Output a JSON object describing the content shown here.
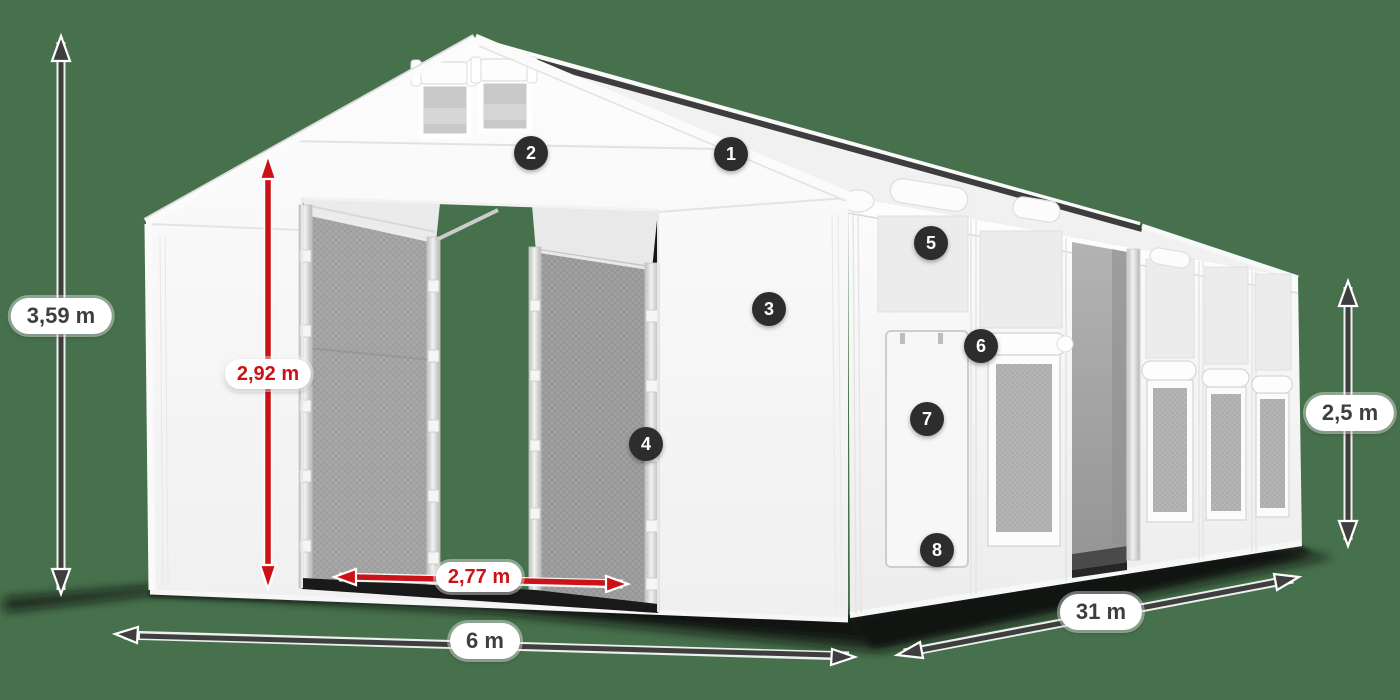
{
  "product_scene": {
    "description": "White PVC storage tent 6 m x 31 m, 3D product render on green background with dimension arrows and numbered feature callouts",
    "background_color": "#47714C"
  },
  "dimension_labels": {
    "total_height": "3,59 m",
    "clear_height": "2,92 m",
    "entrance_width": "2,77 m",
    "tent_width": "6 m",
    "tent_length": "31 m",
    "side_height": "2,5 m"
  },
  "annotation_style": {
    "dark_arrow_color": "#3E3E3E",
    "red_arrow_color": "#CB1217",
    "label_background": "#FFFFFF",
    "label_text_dark": "#3E3E3E",
    "label_text_red": "#CB1217",
    "callout_background": "#2D2D2D",
    "callout_text_color": "#FFFFFF"
  },
  "callouts": [
    {
      "number": "1"
    },
    {
      "number": "2"
    },
    {
      "number": "3"
    },
    {
      "number": "4"
    },
    {
      "number": "5"
    },
    {
      "number": "6"
    },
    {
      "number": "7"
    },
    {
      "number": "8"
    }
  ]
}
